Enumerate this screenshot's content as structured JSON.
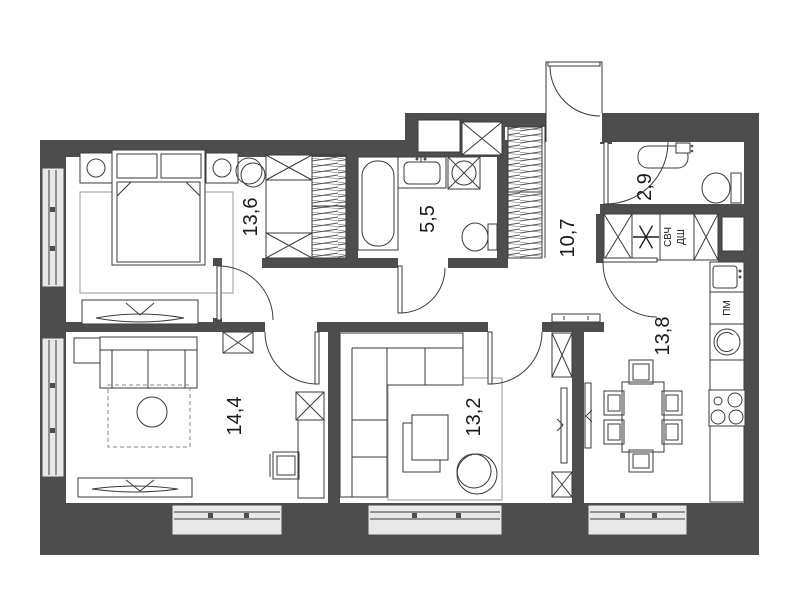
{
  "rooms": {
    "bedroom": {
      "area": "13,6"
    },
    "bathroom": {
      "area": "5,5"
    },
    "wc": {
      "area": "2,9"
    },
    "hallway": {
      "area": "10,7"
    },
    "kitchen": {
      "area": "13,8"
    },
    "room": {
      "area": "14,4"
    },
    "living_room": {
      "area": "13,2"
    }
  },
  "appliance_labels": {
    "microwave": "СВЧ",
    "oven": "ДШ",
    "dishwasher": "ПМ"
  },
  "colors": {
    "wall": "#4d4d4d",
    "line": "#3a3a3a",
    "window_fill": "#e8e8e8"
  }
}
